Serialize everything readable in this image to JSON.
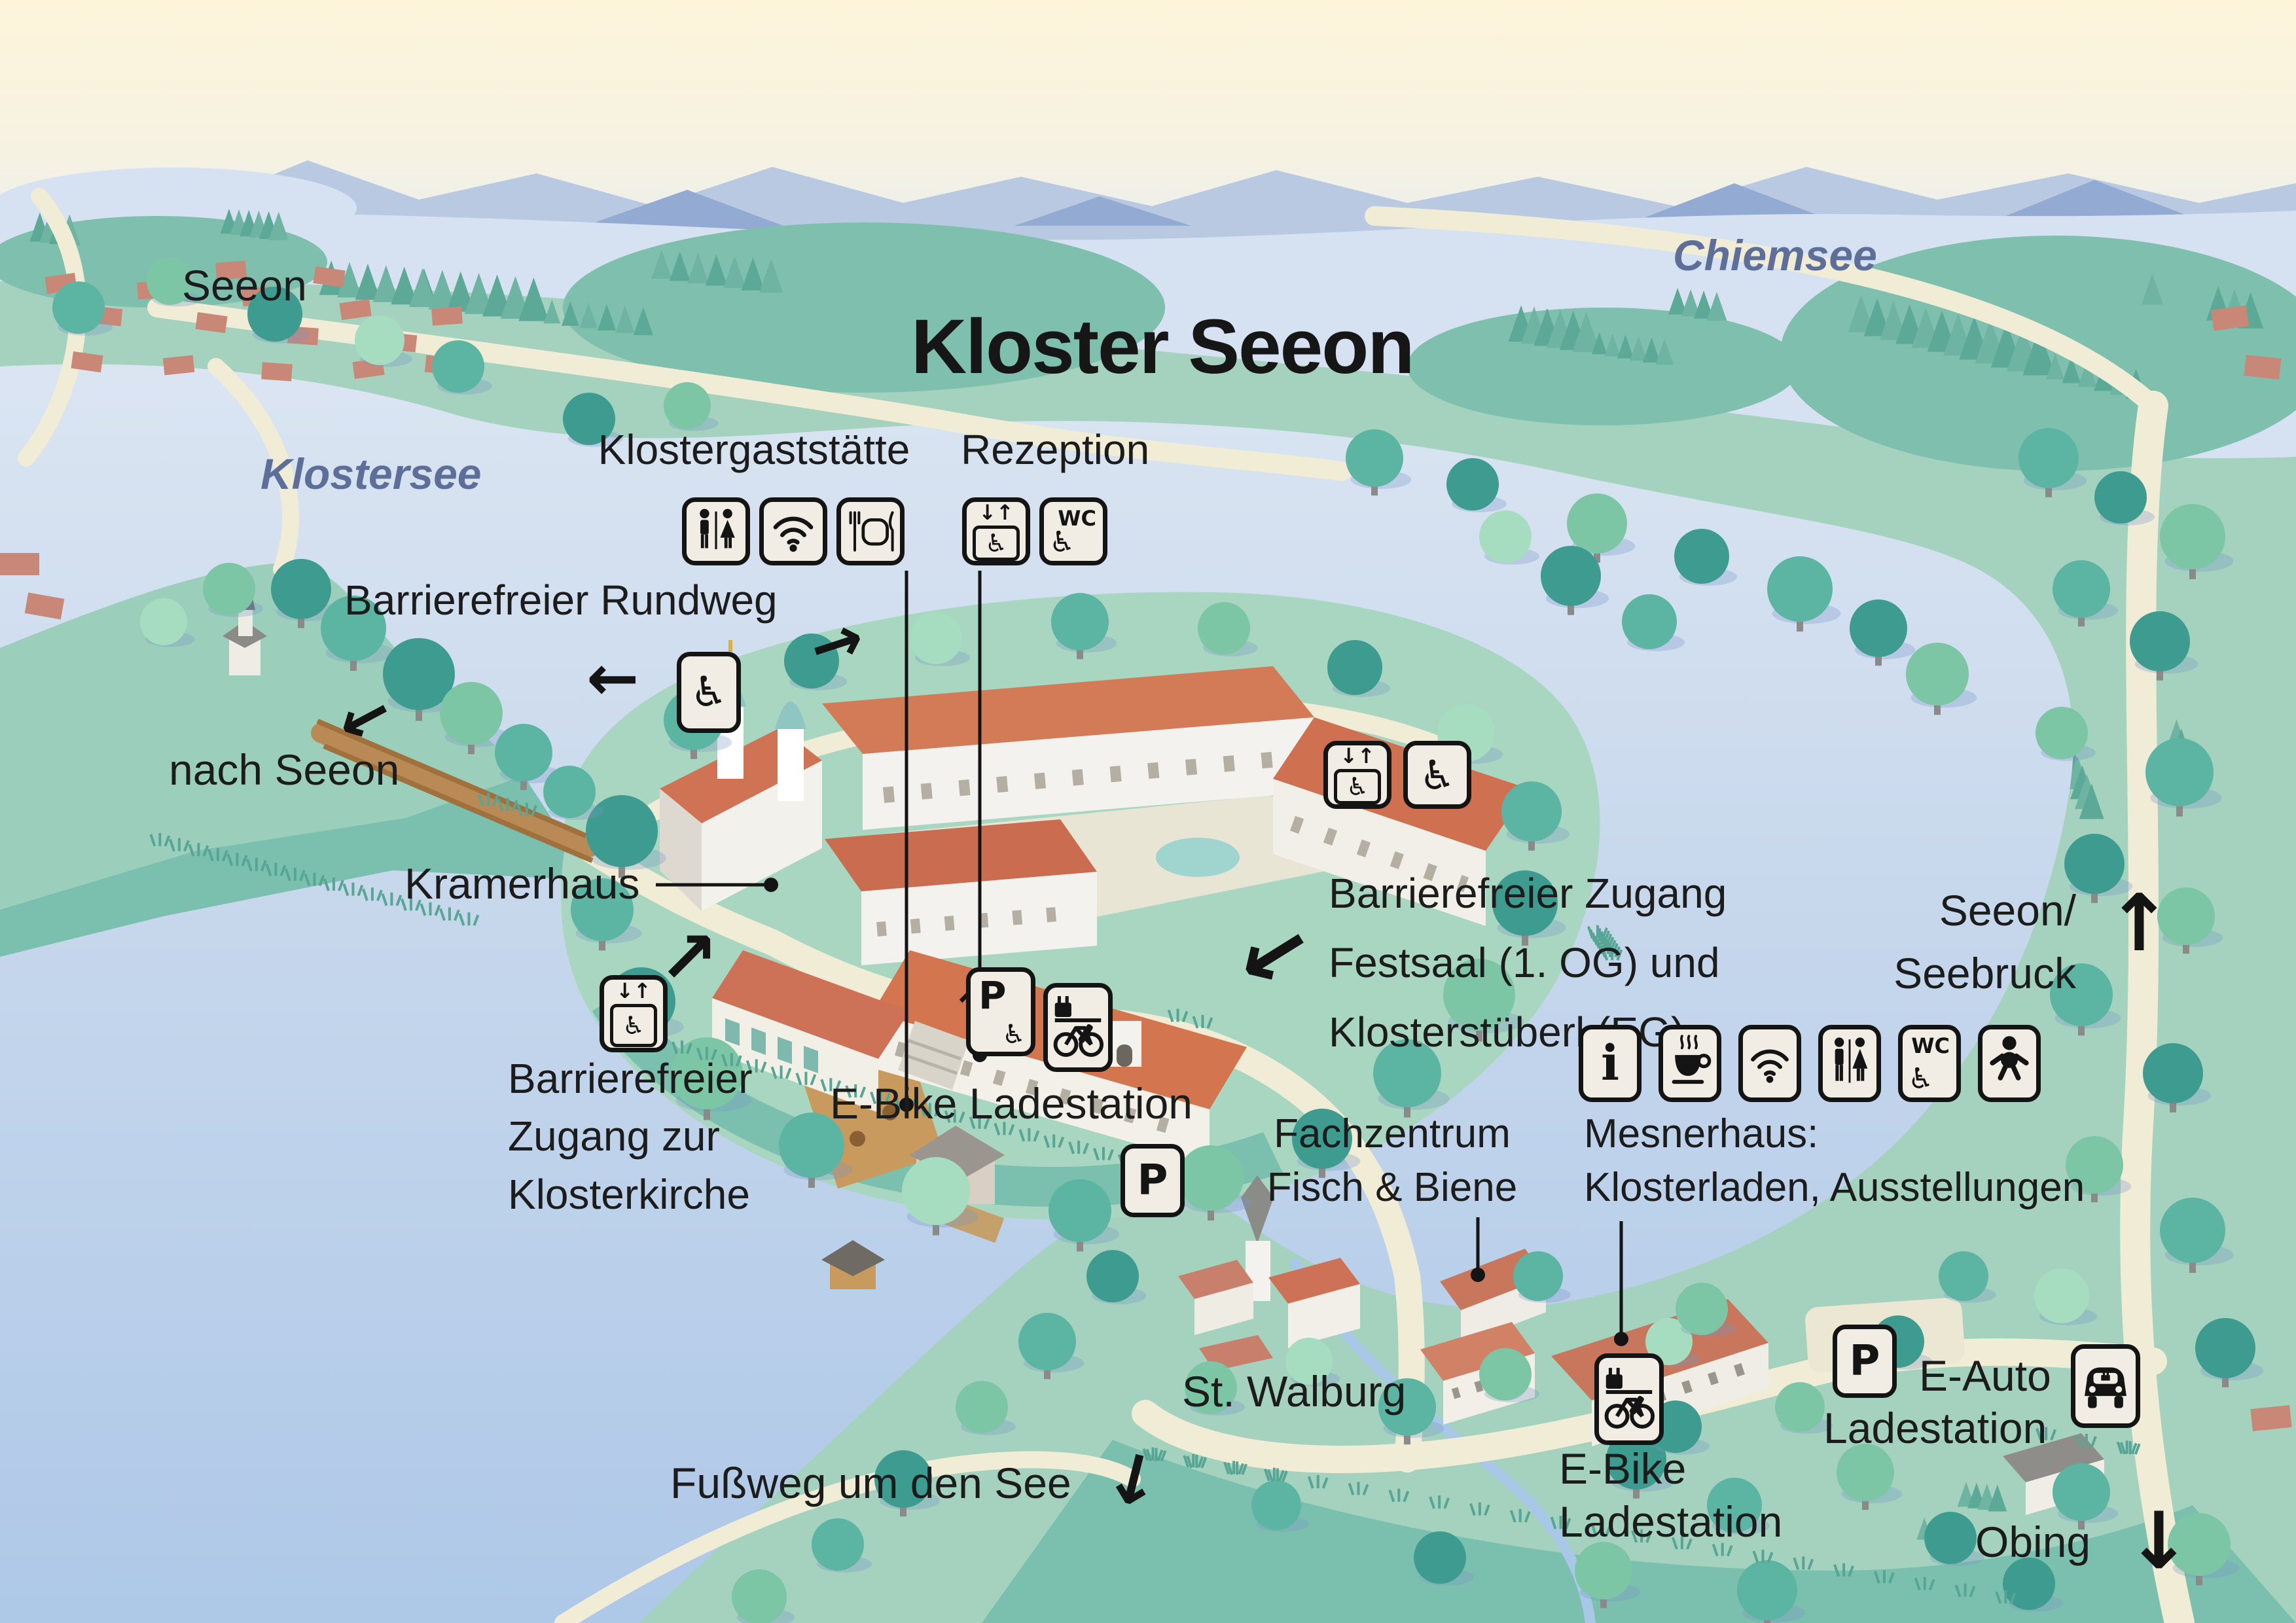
{
  "title": "Kloster Seeon",
  "water_labels": {
    "chiemsee": "Chiemsee",
    "klostersee": "Klostersee"
  },
  "places": {
    "seeon": "Seeon",
    "nach_seeon": "nach Seeon",
    "kramerhaus": "Kramerhaus",
    "st_walburg": "St. Walburg",
    "obing": "Obing",
    "seebruck_1": "Seeon/",
    "seebruck_2": "Seebruck",
    "fussweg": "Fußweg um den See"
  },
  "pois": {
    "klostergaststaette": {
      "label": "Klostergaststätte",
      "icons": [
        "wc-icon",
        "wifi-icon",
        "restaurant-icon"
      ]
    },
    "rezeption": {
      "label": "Rezeption",
      "icons": [
        "elevator-icon",
        "wc-accessible-icon"
      ]
    },
    "rundweg": {
      "label": "Barrierefreier Rundweg",
      "icons": [
        "wheelchair-icon"
      ]
    },
    "festsaal": {
      "line1": "Barrierefreier Zugang",
      "line2": "Festsaal (1. OG) und",
      "line3": "Klosterstüberl (EG)",
      "icons": [
        "elevator-icon",
        "wheelchair-icon"
      ]
    },
    "klosterkirche": {
      "line1": "Barrierefreier",
      "line2": "Zugang zur",
      "line3": "Klosterkirche",
      "icons": [
        "elevator-icon"
      ]
    },
    "ebike_mitte": {
      "label": "E-Bike Ladestation",
      "icons": [
        "accessible-parking-icon",
        "ebike-charging-icon"
      ]
    },
    "parkplatz_mitte": {
      "label": "P",
      "icons": [
        "parking-icon"
      ]
    },
    "fachzentrum": {
      "line1": "Fachzentrum",
      "line2": "Fisch & Biene"
    },
    "mesnerhaus": {
      "line1": "Mesnerhaus:",
      "line2": "Klosterladen, Ausstellungen",
      "icons": [
        "info-icon",
        "cafe-icon",
        "wifi-icon",
        "wc-icon",
        "wc-accessible-icon",
        "baby-changing-icon"
      ]
    },
    "ebike_sued": {
      "line1": "E-Bike",
      "line2": "Ladestation",
      "icons": [
        "ebike-charging-icon"
      ]
    },
    "eauto": {
      "line1": "E-Auto",
      "line2": "Ladestation",
      "icons": [
        "parking-icon",
        "ecar-charging-icon"
      ]
    }
  },
  "icon_text": {
    "wc": "WC",
    "parking": "P",
    "info": "i",
    "elevator_arrows": "↓↑",
    "wheelchair": "♿"
  },
  "arrows": {
    "left": "←",
    "right": "→",
    "up": "↑",
    "down": "↓",
    "up_right": "↗"
  },
  "colors": {
    "roof": "#cd6f52",
    "water": "#b9cfe9",
    "land": "#a4d2bf",
    "marsh": "#7bbfae",
    "tree_dark": "#3d9c8f",
    "road": "#f1ecd6",
    "label_text": "#1c1c1c",
    "lake_label": "#5d6f99",
    "icon_bg": "#f2ede4",
    "sky": "#fdf4da",
    "mountains": "#9db3d6"
  }
}
